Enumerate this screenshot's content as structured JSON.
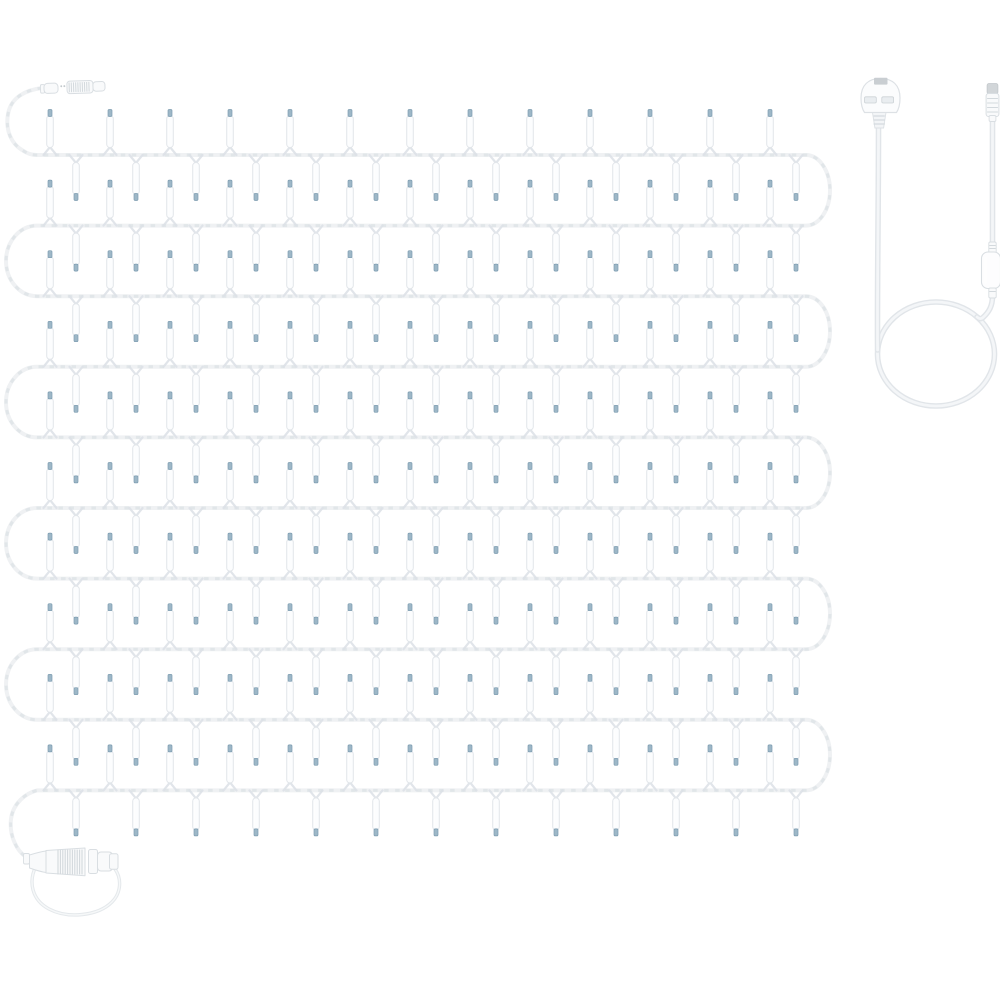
{
  "meta": {
    "description": "Product photo of a white-wire mini string light set laid out in serpentine rows, with a starter connector (top left), an end-to-end connector with coiled lead (bottom left), and a separate mains power lead with UK plug, cable coil, inline controller and socket tip (right side)",
    "background": "#ffffff"
  },
  "palette": {
    "background": "#ffffff",
    "wire": "#eff1f3",
    "wire_shade": "#dce1e6",
    "bulb_body": "#fcfdfe",
    "bulb_outline": "#e2e6ea",
    "bulb_highlight": "#ffffff",
    "bulb_tip": "#9db7c7",
    "bulb_tip_edge": "#7e9db1",
    "part_fill": "#f9fafb",
    "part_outline": "#d9dee2",
    "part_rib": "#d3d9dd",
    "cap_gray": "#d2d6d9",
    "cable_outer": "#e1e5e9",
    "cable_inner": "#f4f6f8",
    "loop_outer": "#e4e8eb",
    "loop_inner": "#f6f8f9",
    "plug_fill": "#fbfcfd",
    "plug_outline": "#dde1e5",
    "slot_fill": "#e9edf0",
    "slot_outline": "#ccd2d6",
    "plug_top_block": "#c9ced2"
  },
  "string_lights": {
    "rows": 10,
    "bulbs_per_row_up": 13,
    "bulbs_per_row_down": 13,
    "total_bulbs": 260,
    "geometry": {
      "row_top_y": 155,
      "row_spacing": 70.6,
      "row_left_x": 37,
      "row_right_x": 806,
      "turn_ry": 35.3,
      "right_turn_rx": 24,
      "left_turn_rx": 31,
      "bulb_period": 60,
      "up_first_x": 50,
      "down_first_x": 76,
      "bulb_body_w": 6.6,
      "bulb_body_len": 32,
      "bulb_tip_w": 4,
      "bulb_tip_len": 7,
      "junction_half_w": 6.5,
      "junction_h": 8
    },
    "lead_in_path": "M 42 88 C 26 90 11 97 8 114 C 5 131 12 144 22 150 C 28 154 32 155 37 155",
    "lead_out_path": "C 26 793 13 803 11 819 C 9 836 17 851 26 857"
  },
  "connectors": {
    "starter": {
      "cx": 74,
      "cy": 87.5,
      "tilt_deg": -2
    },
    "end": {
      "cx": 70,
      "cy": 861,
      "loop_path": "M 36 866 C 28 882 32 900 49 909 C 68 919 98 916 112 902 C 121 893 122 879 115 869"
    }
  },
  "power_lead": {
    "plug": {
      "left": 861,
      "right": 900,
      "top": 78,
      "bottom": 112.5
    },
    "strain_relief": {
      "top": 112.5,
      "bottom": 128
    },
    "cable_x_left": 878.5,
    "cable_x_right": 992.5,
    "loop": {
      "cx": 936,
      "cy": 354,
      "rx": 58.5,
      "ry": 52
    },
    "controller": {
      "x": 981.5,
      "y": 252,
      "w": 19,
      "h": 36.5,
      "rx": 6.5
    },
    "tip": {
      "cx": 992.5,
      "cap_top": 83.5,
      "cap_h": 10.5,
      "body_h": 23,
      "neck_h": 6
    }
  }
}
